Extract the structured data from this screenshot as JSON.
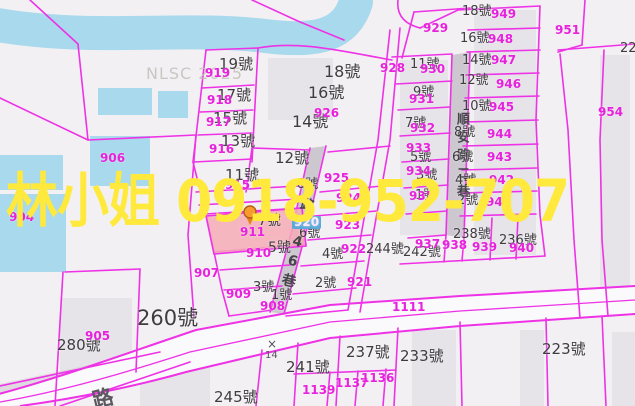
{
  "watermark": {
    "agent": "林小姐",
    "phone": "0918-952-707",
    "full": "林小姐 0918-952-707",
    "color": "#ffe93d"
  },
  "map_watermark": {
    "text": "NLSC 2025",
    "color": "#c3bfba"
  },
  "roads": {
    "lane_246_name": "路246巷",
    "shunan_lane_name": "順安路二巷",
    "corner_road_partial": "路",
    "main_road_id": "1111"
  },
  "survey_marker": {
    "symbol": "×",
    "value": "14"
  },
  "selected_parcel": {
    "id": "911",
    "fill": "#f4acb6",
    "pin_color": "#f79b2e"
  },
  "colors": {
    "boundary": "#ee32e6",
    "water": "#a9d9ec",
    "road_gray": "#cdc8d0",
    "dark_label": "#3f3c40",
    "parcel_id_pink": "#e821dc",
    "watermark_yellow": "#ffe93d",
    "background": "#f3f0f4"
  },
  "labels": {
    "addresses": [
      {
        "t": "19號",
        "x": 219,
        "y": 57,
        "s": 15
      },
      {
        "t": "17號",
        "x": 217,
        "y": 88,
        "s": 15
      },
      {
        "t": "15號",
        "x": 213,
        "y": 111,
        "s": 15
      },
      {
        "t": "13號",
        "x": 221,
        "y": 134,
        "s": 15
      },
      {
        "t": "11號",
        "x": 225,
        "y": 168,
        "s": 15
      },
      {
        "t": "12號",
        "x": 275,
        "y": 151,
        "s": 15
      },
      {
        "t": "7號",
        "x": 258,
        "y": 214,
        "s": 14
      },
      {
        "t": "5號",
        "x": 268,
        "y": 241,
        "s": 14
      },
      {
        "t": "3號",
        "x": 253,
        "y": 281,
        "s": 13
      },
      {
        "t": "1號",
        "x": 271,
        "y": 289,
        "s": 13
      },
      {
        "t": "18號",
        "x": 324,
        "y": 64,
        "s": 16
      },
      {
        "t": "16號",
        "x": 308,
        "y": 85,
        "s": 16
      },
      {
        "t": "14號",
        "x": 292,
        "y": 114,
        "s": 16
      },
      {
        "t": "8號",
        "x": 297,
        "y": 178,
        "s": 13
      },
      {
        "t": "6號",
        "x": 299,
        "y": 227,
        "s": 13
      },
      {
        "t": "4號",
        "x": 322,
        "y": 248,
        "s": 13
      },
      {
        "t": "2號",
        "x": 315,
        "y": 277,
        "s": 13
      },
      {
        "t": "11號",
        "x": 410,
        "y": 58,
        "s": 13
      },
      {
        "t": "9號",
        "x": 413,
        "y": 86,
        "s": 13
      },
      {
        "t": "7號",
        "x": 405,
        "y": 117,
        "s": 13
      },
      {
        "t": "5號",
        "x": 410,
        "y": 151,
        "s": 13
      },
      {
        "t": "3號",
        "x": 416,
        "y": 169,
        "s": 13
      },
      {
        "t": "1號",
        "x": 415,
        "y": 189,
        "s": 13
      },
      {
        "t": "18號",
        "x": 462,
        "y": 5,
        "s": 13
      },
      {
        "t": "16號",
        "x": 460,
        "y": 32,
        "s": 13
      },
      {
        "t": "14號",
        "x": 462,
        "y": 54,
        "s": 13
      },
      {
        "t": "12號",
        "x": 459,
        "y": 74,
        "s": 13
      },
      {
        "t": "10號",
        "x": 462,
        "y": 100,
        "s": 13
      },
      {
        "t": "8號",
        "x": 454,
        "y": 126,
        "s": 13
      },
      {
        "t": "6號",
        "x": 452,
        "y": 151,
        "s": 13
      },
      {
        "t": "4號",
        "x": 455,
        "y": 174,
        "s": 13
      },
      {
        "t": "2號",
        "x": 457,
        "y": 194,
        "s": 13
      },
      {
        "t": "244號",
        "x": 366,
        "y": 243,
        "s": 13
      },
      {
        "t": "242號",
        "x": 403,
        "y": 246,
        "s": 13
      },
      {
        "t": "238號",
        "x": 453,
        "y": 228,
        "s": 13
      },
      {
        "t": "236號",
        "x": 499,
        "y": 234,
        "s": 13
      },
      {
        "t": "260號",
        "x": 137,
        "y": 308,
        "s": 21
      },
      {
        "t": "280號",
        "x": 57,
        "y": 338,
        "s": 15
      },
      {
        "t": "245號",
        "x": 214,
        "y": 390,
        "s": 15
      },
      {
        "t": "241號",
        "x": 286,
        "y": 360,
        "s": 15
      },
      {
        "t": "237號",
        "x": 346,
        "y": 345,
        "s": 15
      },
      {
        "t": "233號",
        "x": 400,
        "y": 349,
        "s": 15
      },
      {
        "t": "223號",
        "x": 542,
        "y": 342,
        "s": 15
      },
      {
        "t": "22",
        "x": 620,
        "y": 42,
        "s": 13
      }
    ],
    "parcel_ids": [
      {
        "t": "919",
        "x": 205,
        "y": 67
      },
      {
        "t": "918",
        "x": 207,
        "y": 94
      },
      {
        "t": "917",
        "x": 206,
        "y": 116
      },
      {
        "t": "916",
        "x": 209,
        "y": 143
      },
      {
        "t": "915",
        "x": 225,
        "y": 179
      },
      {
        "t": "926",
        "x": 314,
        "y": 107
      },
      {
        "t": "925",
        "x": 324,
        "y": 172
      },
      {
        "t": "924",
        "x": 336,
        "y": 192
      },
      {
        "t": "923",
        "x": 335,
        "y": 219
      },
      {
        "t": "922",
        "x": 341,
        "y": 243
      },
      {
        "t": "921",
        "x": 347,
        "y": 276
      },
      {
        "t": "920",
        "x": 292,
        "y": 216,
        "boxed": true
      },
      {
        "t": "911",
        "x": 240,
        "y": 226
      },
      {
        "t": "910",
        "x": 246,
        "y": 247
      },
      {
        "t": "909",
        "x": 226,
        "y": 288
      },
      {
        "t": "908",
        "x": 260,
        "y": 300
      },
      {
        "t": "907",
        "x": 194,
        "y": 267
      },
      {
        "t": "906",
        "x": 100,
        "y": 152
      },
      {
        "t": "905",
        "x": 85,
        "y": 330
      },
      {
        "t": "904",
        "x": 9,
        "y": 211
      },
      {
        "t": "928",
        "x": 380,
        "y": 62
      },
      {
        "t": "929",
        "x": 423,
        "y": 22
      },
      {
        "t": "930",
        "x": 420,
        "y": 63
      },
      {
        "t": "931",
        "x": 409,
        "y": 93
      },
      {
        "t": "932",
        "x": 410,
        "y": 122
      },
      {
        "t": "933",
        "x": 406,
        "y": 142
      },
      {
        "t": "934",
        "x": 406,
        "y": 165
      },
      {
        "t": "935",
        "x": 409,
        "y": 190
      },
      {
        "t": "937",
        "x": 415,
        "y": 238
      },
      {
        "t": "938",
        "x": 442,
        "y": 239
      },
      {
        "t": "939",
        "x": 472,
        "y": 241
      },
      {
        "t": "940",
        "x": 509,
        "y": 242
      },
      {
        "t": "941",
        "x": 486,
        "y": 196
      },
      {
        "t": "942",
        "x": 489,
        "y": 174
      },
      {
        "t": "943",
        "x": 487,
        "y": 151
      },
      {
        "t": "944",
        "x": 487,
        "y": 128
      },
      {
        "t": "945",
        "x": 489,
        "y": 101
      },
      {
        "t": "946",
        "x": 496,
        "y": 78
      },
      {
        "t": "947",
        "x": 491,
        "y": 54
      },
      {
        "t": "948",
        "x": 488,
        "y": 33
      },
      {
        "t": "949",
        "x": 491,
        "y": 8
      },
      {
        "t": "951",
        "x": 555,
        "y": 24
      },
      {
        "t": "954",
        "x": 598,
        "y": 106
      },
      {
        "t": "1111",
        "x": 392,
        "y": 301
      },
      {
        "t": "1137",
        "x": 335,
        "y": 377
      },
      {
        "t": "1136",
        "x": 361,
        "y": 372
      },
      {
        "t": "1139",
        "x": 302,
        "y": 384
      }
    ]
  }
}
